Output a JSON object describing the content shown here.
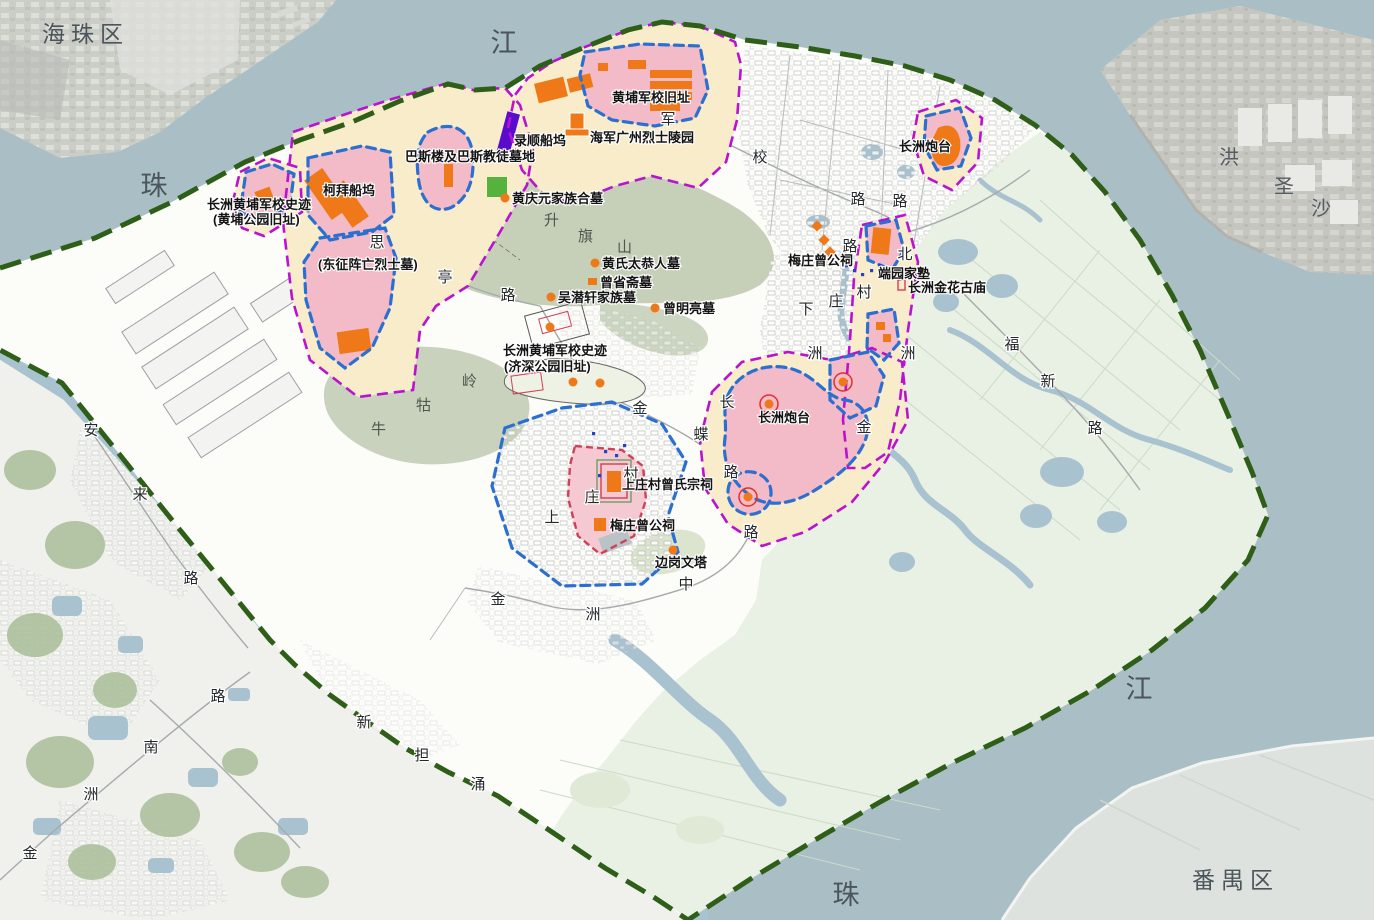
{
  "map_type": "heritage-conservation-planning-map",
  "colors": {
    "water": "#a9bfc5",
    "island_base": "#fcfcf9",
    "fields_green": "#e9f0e4",
    "hill_green": "#c6d0b9",
    "construction_control_cream": "#f9ecca",
    "protection_pink": "#f3bac7",
    "heritage_orange": "#ef7918",
    "dock_purple": "#5a0ccc",
    "boundary_green": "#2e5e17",
    "control_line_magenta": "#b913cf",
    "protection_line_blue": "#2b6fd0",
    "village_line_red": "#d04058"
  },
  "labels": {
    "water": [
      {
        "t": "江",
        "x": 505,
        "y": 52
      },
      {
        "t": "珠",
        "x": 155,
        "y": 195
      },
      {
        "t": "江",
        "x": 1140,
        "y": 698
      },
      {
        "t": "珠",
        "x": 847,
        "y": 904
      }
    ],
    "districts": [
      {
        "t": "海珠区",
        "x": 42,
        "y": 42,
        "a": "s"
      },
      {
        "t": "番禺区",
        "x": 1192,
        "y": 888,
        "a": "s"
      }
    ],
    "shoal": [
      {
        "t": "洪",
        "x": 1229,
        "y": 164
      },
      {
        "t": "圣",
        "x": 1284,
        "y": 193
      },
      {
        "t": "沙",
        "x": 1321,
        "y": 215
      }
    ],
    "hills": [
      {
        "t": "升",
        "x": 552,
        "y": 225
      },
      {
        "t": "旗",
        "x": 586,
        "y": 241
      },
      {
        "t": "山",
        "x": 625,
        "y": 252
      },
      {
        "t": "牛",
        "x": 379,
        "y": 434
      },
      {
        "t": "牯",
        "x": 424,
        "y": 410
      },
      {
        "t": "岭",
        "x": 470,
        "y": 386
      }
    ],
    "roads": [
      {
        "t": "军",
        "x": 668,
        "y": 124
      },
      {
        "t": "校",
        "x": 760,
        "y": 162
      },
      {
        "t": "路",
        "x": 858,
        "y": 204
      },
      {
        "t": "路",
        "x": 900,
        "y": 206
      },
      {
        "t": "路",
        "x": 850,
        "y": 251
      },
      {
        "t": "北",
        "x": 905,
        "y": 259
      },
      {
        "t": "洲",
        "x": 908,
        "y": 358
      },
      {
        "t": "金",
        "x": 864,
        "y": 432
      },
      {
        "t": "下",
        "x": 806,
        "y": 314
      },
      {
        "t": "庄",
        "x": 836,
        "y": 306
      },
      {
        "t": "村",
        "x": 864,
        "y": 297
      },
      {
        "t": "洲",
        "x": 815,
        "y": 358
      },
      {
        "t": "思",
        "x": 377,
        "y": 247
      },
      {
        "t": "亭",
        "x": 445,
        "y": 282
      },
      {
        "t": "路",
        "x": 508,
        "y": 300
      },
      {
        "t": "长",
        "x": 727,
        "y": 407
      },
      {
        "t": "金",
        "x": 640,
        "y": 413
      },
      {
        "t": "蝶",
        "x": 701,
        "y": 439
      },
      {
        "t": "路",
        "x": 731,
        "y": 477
      },
      {
        "t": "路",
        "x": 751,
        "y": 537
      },
      {
        "t": "上",
        "x": 552,
        "y": 522
      },
      {
        "t": "庄",
        "x": 592,
        "y": 502
      },
      {
        "t": "村",
        "x": 631,
        "y": 479
      },
      {
        "t": "金",
        "x": 498,
        "y": 604
      },
      {
        "t": "洲",
        "x": 593,
        "y": 619
      },
      {
        "t": "中",
        "x": 686,
        "y": 589
      },
      {
        "t": "金",
        "x": 30,
        "y": 858
      },
      {
        "t": "洲",
        "x": 91,
        "y": 799
      },
      {
        "t": "南",
        "x": 151,
        "y": 752
      },
      {
        "t": "路",
        "x": 218,
        "y": 701
      },
      {
        "t": "安",
        "x": 91,
        "y": 435
      },
      {
        "t": "来",
        "x": 140,
        "y": 499
      },
      {
        "t": "路",
        "x": 191,
        "y": 583
      },
      {
        "t": "福",
        "x": 1012,
        "y": 349
      },
      {
        "t": "新",
        "x": 1048,
        "y": 386
      },
      {
        "t": "路",
        "x": 1095,
        "y": 433
      },
      {
        "t": "新",
        "x": 364,
        "y": 727
      },
      {
        "t": "担",
        "x": 422,
        "y": 760
      },
      {
        "t": "涌",
        "x": 478,
        "y": 789
      }
    ],
    "sites": [
      {
        "t": "黄埔军校旧址",
        "x": 612,
        "y": 102,
        "a": "s"
      },
      {
        "t": "海军广州烈士陵园",
        "x": 590,
        "y": 142,
        "a": "s"
      },
      {
        "t": "录顺船坞",
        "x": 514,
        "y": 145,
        "a": "s"
      },
      {
        "t": "巴斯楼及巴斯教徒墓地",
        "x": 405,
        "y": 161,
        "a": "s"
      },
      {
        "t": "柯拜船坞",
        "x": 323,
        "y": 195,
        "a": "s"
      },
      {
        "t": "长洲黄埔军校史迹",
        "x": 207,
        "y": 209,
        "a": "s"
      },
      {
        "t": "(黄埔公园旧址)",
        "x": 213,
        "y": 224,
        "a": "s"
      },
      {
        "t": "(东征阵亡烈士墓)",
        "x": 318,
        "y": 269,
        "a": "s"
      },
      {
        "t": "黄庆元家族合墓",
        "x": 512,
        "y": 203,
        "a": "s"
      },
      {
        "t": "黄氏太恭人墓",
        "x": 602,
        "y": 268,
        "a": "s"
      },
      {
        "t": "曾省斋墓",
        "x": 600,
        "y": 287,
        "a": "s"
      },
      {
        "t": "吴潜轩家族墓",
        "x": 558,
        "y": 302,
        "a": "s"
      },
      {
        "t": "曾明亮墓",
        "x": 663,
        "y": 313,
        "a": "s"
      },
      {
        "t": "长洲黄埔军校史迹",
        "x": 503,
        "y": 355,
        "a": "s"
      },
      {
        "t": "(济深公园旧址)",
        "x": 504,
        "y": 371,
        "a": "s"
      },
      {
        "t": "梅庄曾公祠",
        "x": 788,
        "y": 265,
        "a": "s"
      },
      {
        "t": "端园家塾",
        "x": 878,
        "y": 278,
        "a": "s"
      },
      {
        "t": "长洲金花古庙",
        "x": 908,
        "y": 292,
        "a": "s"
      },
      {
        "t": "长洲炮台",
        "x": 899,
        "y": 151,
        "a": "s"
      },
      {
        "t": "长洲炮台",
        "x": 758,
        "y": 422,
        "a": "s"
      },
      {
        "t": "上庄村曾氏宗祠",
        "x": 622,
        "y": 489,
        "a": "s"
      },
      {
        "t": "梅庄曾公祠",
        "x": 610,
        "y": 530,
        "a": "s"
      },
      {
        "t": "边岗文塔",
        "x": 655,
        "y": 567,
        "a": "s"
      }
    ]
  },
  "markers": [
    {
      "type": "dot",
      "x": 505,
      "y": 198
    },
    {
      "type": "dot",
      "x": 595,
      "y": 263
    },
    {
      "type": "dot",
      "x": 551,
      "y": 297
    },
    {
      "type": "dot",
      "x": 655,
      "y": 308
    },
    {
      "type": "dot",
      "x": 550,
      "y": 327
    },
    {
      "type": "dot",
      "x": 573,
      "y": 382
    },
    {
      "type": "dot",
      "x": 600,
      "y": 383
    },
    {
      "type": "dot",
      "x": 673,
      "y": 550
    },
    {
      "type": "sq",
      "x": 588,
      "y": 278
    },
    {
      "type": "rcdot",
      "x": 769,
      "y": 404
    },
    {
      "type": "rcdot",
      "x": 843,
      "y": 382
    },
    {
      "type": "rcdot",
      "x": 748,
      "y": 497
    },
    {
      "type": "redmark",
      "x": 898,
      "y": 280
    },
    {
      "type": "bluedot",
      "x": 845,
      "y": 264
    },
    {
      "type": "bluedot",
      "x": 853,
      "y": 269
    },
    {
      "type": "bluedot",
      "x": 861,
      "y": 273
    },
    {
      "type": "bluedot",
      "x": 870,
      "y": 269
    },
    {
      "type": "bluedot",
      "x": 878,
      "y": 264
    },
    {
      "type": "bluedot",
      "x": 604,
      "y": 450
    },
    {
      "type": "bluedot",
      "x": 592,
      "y": 432
    },
    {
      "type": "bluedot",
      "x": 615,
      "y": 454
    },
    {
      "type": "bluedot",
      "x": 598,
      "y": 474
    },
    {
      "type": "bluedot",
      "x": 623,
      "y": 444
    },
    {
      "type": "diamond",
      "x": 817,
      "y": 226
    },
    {
      "type": "diamond",
      "x": 824,
      "y": 240
    },
    {
      "type": "diamond",
      "x": 830,
      "y": 252
    }
  ]
}
